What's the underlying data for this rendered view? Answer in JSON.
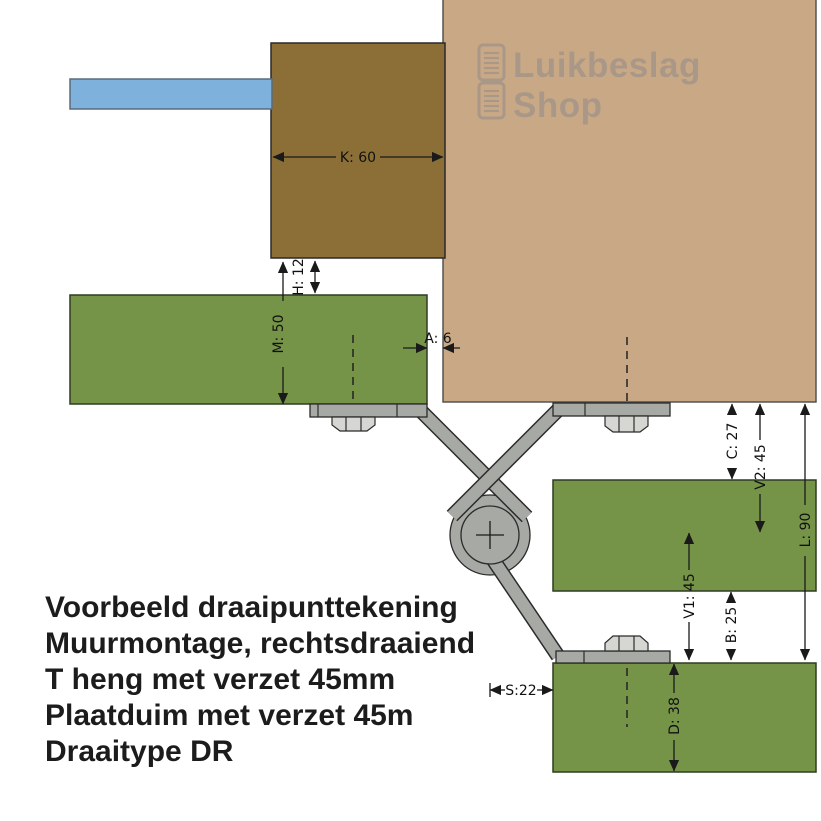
{
  "logo": {
    "icon": "shutter-panels-icon",
    "line1": "Luikbeslag",
    "line2": "Shop"
  },
  "dimensions": {
    "K": "K: 60",
    "H": "H: 12",
    "M": "M: 50",
    "A": "A: 6",
    "C": "C: 27",
    "V2": "V2: 45",
    "L": "L: 90",
    "V1": "V1: 45",
    "B": "B: 25",
    "S": "S:22",
    "D": "D: 38"
  },
  "caption": {
    "line1": "Voorbeeld draaipunttekening",
    "line2": "Muurmontage, rechtsdraaiend",
    "line3": "T heng met verzet 45mm",
    "line4": "Plaatduim met verzet 45m",
    "line5": "Draaitype DR"
  },
  "colors": {
    "wall": "#c9a885",
    "frame_wood": "#8b6f37",
    "shutter_wood": "#769448",
    "wall_anchor_blue": "#7eb1dc",
    "hinge_metal": "#a7aaa4",
    "bolt_metal": "#d6d6d2",
    "dimension_ink": "#1a1a1a",
    "logo_gray": "#8a8a8a"
  }
}
